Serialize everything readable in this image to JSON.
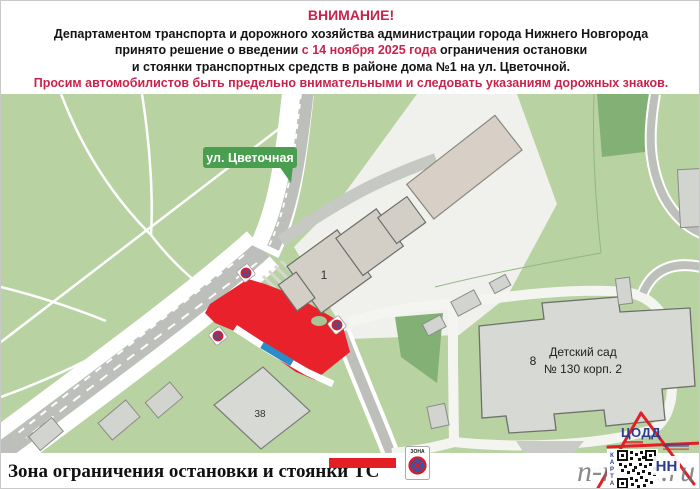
{
  "header": {
    "title": "ВНИМАНИЕ!",
    "line1": "Департаментом транспорта и дорожного хозяйства администрации города Нижнего Новгорода",
    "line2_pre": "принято решение о введении ",
    "line2_highlight": "с 14 ноября 2025 года",
    "line2_post": " ограничения остановки",
    "line3": "и стоянки транспортных средств в районе дома №1 на ул. Цветочной.",
    "warning": "Просим автомобилистов быть предельно внимательными и следовать указаниям дорожных знаков."
  },
  "map": {
    "street_label": "ул. Цветочная",
    "building1_label": "1",
    "building8_label": "8",
    "building38_label": "38",
    "kindergarten_line1": "Детский сад",
    "kindergarten_line2": "№ 130 корп. 2"
  },
  "legend": {
    "label": "Зона ограничения остановки и стоянки ТС",
    "zone_sign_text": "ЗОНА"
  },
  "branding": {
    "org": "ЦОДД",
    "city_code": "НН",
    "qr_label_letters": [
      "К",
      "А",
      "Р",
      "Т",
      "А"
    ],
    "watermark_left": "n-n",
    "watermark_right": "52.ru"
  },
  "colors": {
    "accent": "#c8234c",
    "restriction_zone": "#e8212b",
    "legend_bar": "#e31e24",
    "street_label_bg": "#4a9e50",
    "park_green": "#b8d2a2",
    "logo_blue": "#2b3c8c",
    "logo_red": "#e31e24"
  }
}
